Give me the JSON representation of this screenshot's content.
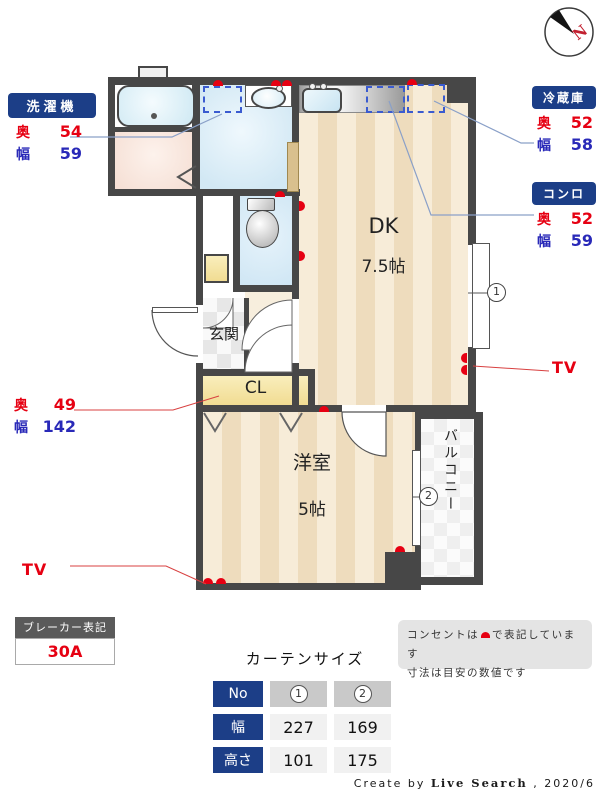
{
  "compass": {
    "north": "N"
  },
  "labels": {
    "washer": {
      "title": "洗濯機",
      "oku_k": "奥",
      "oku": "54",
      "haba_k": "幅",
      "haba": "59"
    },
    "fridge": {
      "title": "冷蔵庫",
      "oku_k": "奥",
      "oku": "52",
      "haba_k": "幅",
      "haba": "58"
    },
    "stove": {
      "title": "コンロ",
      "oku_k": "奥",
      "oku": "52",
      "haba_k": "幅",
      "haba": "59"
    },
    "closet": {
      "oku_k": "奥",
      "oku": "49",
      "haba_k": "幅",
      "haba": "142"
    },
    "tv_left": "TV",
    "tv_right": "TV"
  },
  "rooms": {
    "dk": {
      "name": "DK",
      "size": "7.5帖"
    },
    "living": {
      "name": "洋室",
      "size": "5帖"
    },
    "entrance": {
      "name": "玄関"
    },
    "closet": {
      "name": "CL"
    },
    "balcony": {
      "name": "バルコニー"
    }
  },
  "markers": {
    "window1": "1",
    "window2": "2"
  },
  "breaker": {
    "title": "ブレーカー表記",
    "value": "30A"
  },
  "note": {
    "line1_pre": "コンセントは",
    "line1_post": "で表記しています",
    "line2": "寸法は目安の数値です"
  },
  "curtain": {
    "title": "カーテンサイズ",
    "row_no": {
      "h": "No",
      "c1": "1",
      "c2": "2"
    },
    "row_width": {
      "h": "幅",
      "c1": "227",
      "c2": "169"
    },
    "row_height": {
      "h": "高さ",
      "c1": "101",
      "c2": "175"
    }
  },
  "footer": {
    "prefix": "Create by ",
    "brand": "Live Search",
    "suffix": " , 2020/6"
  },
  "colors": {
    "accent_navy": "#1c3e87",
    "dim_red": "#e60012",
    "dim_blue": "#2929b8",
    "wall": "#474747"
  }
}
